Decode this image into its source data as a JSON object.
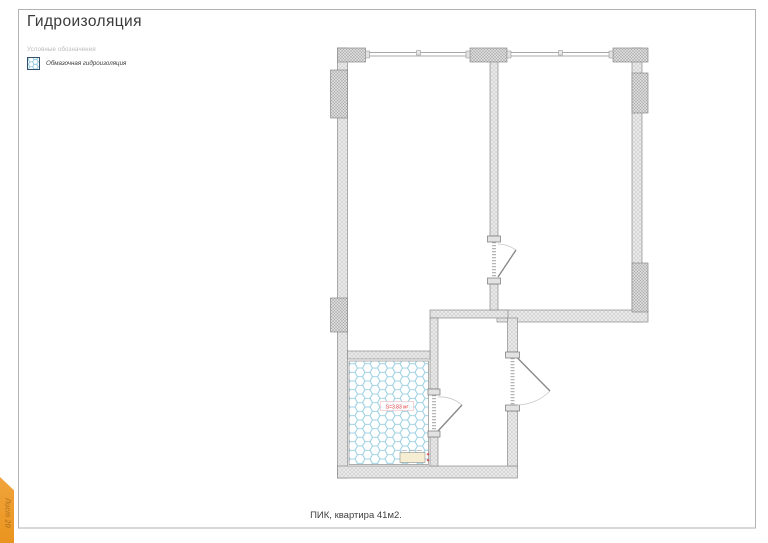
{
  "page": {
    "title": "Гидроизоляция",
    "caption": "ПИК, квартира 41м2.",
    "sheet_tab_label": "Лист 20"
  },
  "legend": {
    "section_label": "Условные обозначения",
    "items": [
      {
        "label": "Обмазочная гидроизоляция",
        "swatch": "hex-tile-pattern"
      }
    ]
  },
  "plan": {
    "bathroom_area_label": "S=3.83 м²"
  },
  "colors": {
    "accent_orange": "#ED9B2F",
    "tile_blue": "#9FD2E3",
    "wall_fill_gray": "#E9E9E9",
    "pier_fill_gray": "#DCDCDC",
    "wall_outline_gray": "#8C8C8C",
    "area_label_red": "#E03535",
    "frame_gray": "#B2B2B2"
  }
}
